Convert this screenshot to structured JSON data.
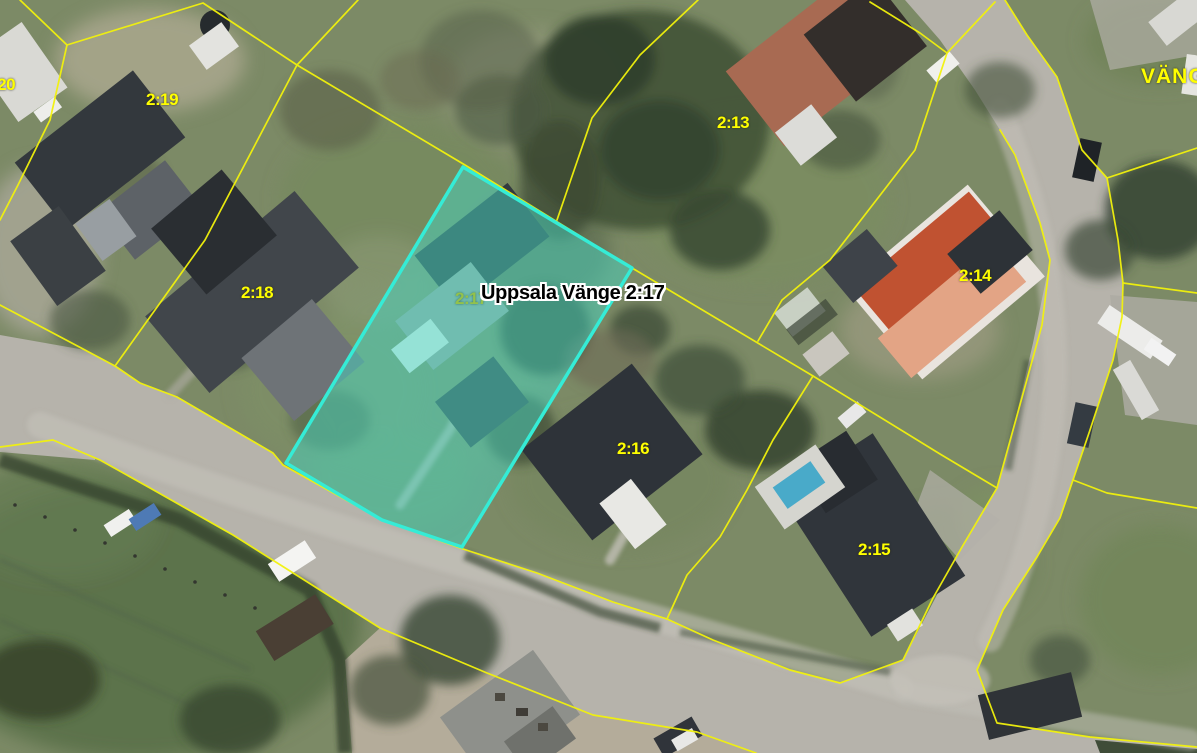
{
  "map": {
    "district_label": "VÄNGE",
    "highlight_label": "Uppsala Vänge 2:17",
    "highlighted_parcel": {
      "id": "2:17",
      "fill_color": "#46d6c2",
      "stroke_color": "#35ecd6"
    },
    "boundary_color": "#f2f20c",
    "parcel_label_color": "#ffff00",
    "hidden_parcel_label_color": "#93c24b",
    "parcel_labels": [
      {
        "id": "2:20"
      },
      {
        "id": "2:19"
      },
      {
        "id": "2:18"
      },
      {
        "id": "2:13"
      },
      {
        "id": "2:14"
      },
      {
        "id": "2:16"
      },
      {
        "id": "2:15"
      },
      {
        "id": "2:17"
      }
    ]
  }
}
